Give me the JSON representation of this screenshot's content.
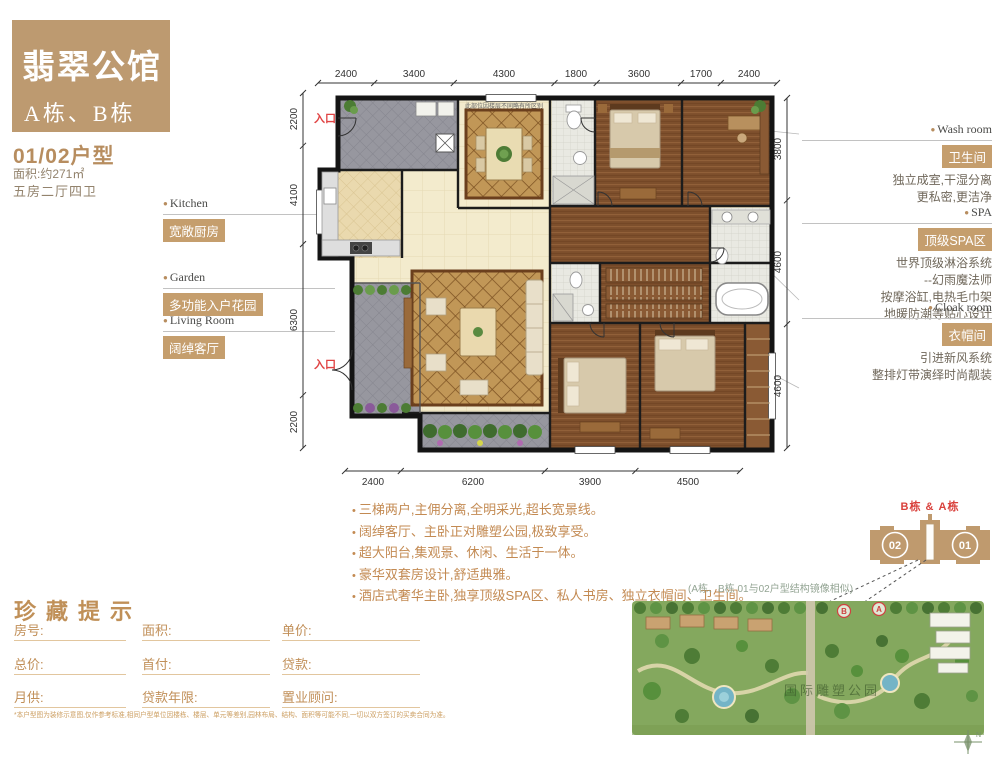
{
  "brand": {
    "title": "翡翠公馆",
    "subtitle": "A栋、B栋"
  },
  "unit": {
    "type": "01/02户型",
    "area": "面积:约271㎡",
    "rooms": "五房二厅四卫"
  },
  "features_left": [
    {
      "en": "Kitchen",
      "badge": "宽敞厨房"
    },
    {
      "en": "Garden",
      "badge": "多功能入户花园"
    },
    {
      "en": "Living Room",
      "badge": "阔绰客厅"
    }
  ],
  "features_right": [
    {
      "en": "Wash room",
      "badge": "卫生间",
      "lines": [
        "独立成室,干湿分离",
        "更私密,更洁净"
      ]
    },
    {
      "en": "SPA",
      "badge": "顶级SPA区",
      "lines": [
        "世界顶级淋浴系统",
        "--幻雨魔法师",
        "按摩浴缸,电热毛巾架",
        "地暖防潮等贴心设计"
      ]
    },
    {
      "en": "Cloak room",
      "badge": "衣帽间",
      "lines": [
        "引进新风系统",
        "整排灯带演绎时尚靓装"
      ]
    }
  ],
  "plan": {
    "entrance_label": "入口",
    "note": "此部位因楼层不同略有所区别",
    "dims_top": [
      "2400",
      "3400",
      "4300",
      "1800",
      "3600",
      "1700",
      "2400"
    ],
    "dims_bottom": [
      "2400",
      "6200",
      "3900",
      "4500"
    ],
    "dims_left": [
      "2200",
      "4100",
      "6300",
      "2200"
    ],
    "dims_right": [
      "3800",
      "4600",
      "4600"
    ]
  },
  "selling_points": [
    "三梯两户,主佣分离,全明采光,超长宽景线。",
    "阔绰客厅、主卧正对雕塑公园,极致享受。",
    "超大阳台,集观景、休闲、生活于一体。",
    "豪华双套房设计,舒适典雅。",
    "酒店式奢华主卧,独享顶级SPA区、私人书房、独立衣帽间、卫生间。"
  ],
  "form": {
    "title": "珍藏提示",
    "fields": [
      [
        "房号:",
        "面积:",
        "单价:"
      ],
      [
        "总价:",
        "首付:",
        "贷款:"
      ],
      [
        "月供:",
        "贷款年限:",
        "置业顾问:"
      ]
    ],
    "disclaimer": "*本户型图为装修示意图,仅作参考标准,相同户型单位因楼栋、楼层、单元等差别,园林布局、结构、面积等可能不同,一切以双方签订的买卖合同为准。"
  },
  "locator": {
    "building_label": "B栋 & A栋",
    "unit_left": "02",
    "unit_right": "01",
    "caption": "(A栋、B栋 01与02户型结构镜像相似)",
    "watermark": "国际雕塑公园",
    "marker_b": "B",
    "marker_a": "A",
    "compass": "N"
  },
  "colors": {
    "accent": "#bd9a70",
    "badge": "#c59e6d",
    "red": "#d9413c",
    "text_tan": "#c38a52"
  }
}
